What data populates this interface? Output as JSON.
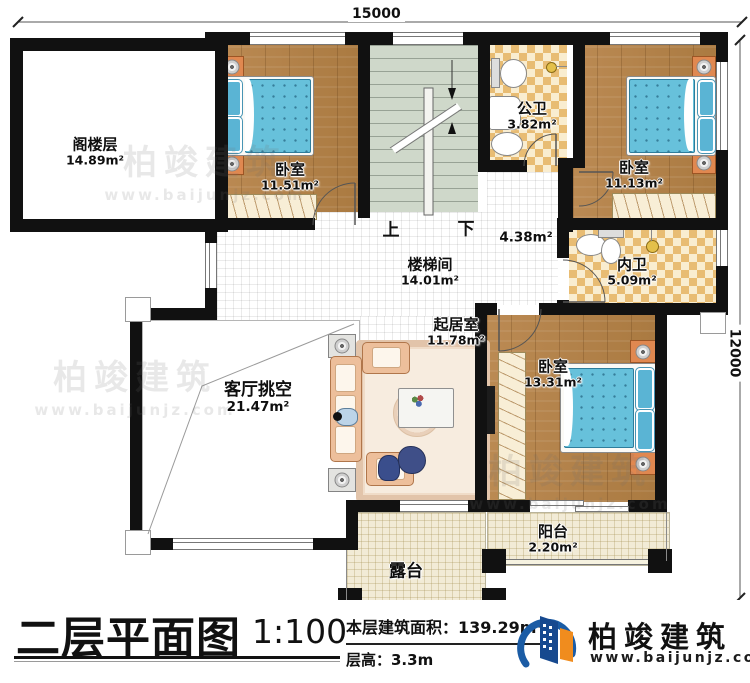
{
  "dimensions": {
    "width_top": "15000",
    "height_right": "12000"
  },
  "rooms": {
    "attic": {
      "name": "阁楼层",
      "area": "14.89m²"
    },
    "bedroom1": {
      "name": "卧室",
      "area": "11.51m²"
    },
    "public_bath": {
      "name": "公卫",
      "area": "3.82m²"
    },
    "bedroom2": {
      "name": "卧室",
      "area": "11.13m²"
    },
    "stairwell": {
      "name": "楼梯间",
      "area": "14.01m²"
    },
    "hall": {
      "area": "4.38m²"
    },
    "ensuite_bath": {
      "name": "内卫",
      "area": "5.09m²"
    },
    "sitting": {
      "name": "起居室",
      "area": "11.78m²"
    },
    "living_void": {
      "name": "客厅挑空",
      "area": "21.47m²"
    },
    "bedroom3": {
      "name": "卧室",
      "area": "13.31m²"
    },
    "balcony": {
      "name": "阳台",
      "area": "2.20m²"
    },
    "terrace": {
      "name": "露台"
    }
  },
  "stairs": {
    "up": "上",
    "down": "下"
  },
  "footer": {
    "title": "二层平面图",
    "scale": "1:100",
    "area_line": "本层建筑面积：139.29m²",
    "floor_height_line": "层高：3.3m"
  },
  "brand": {
    "name": "柏竣建筑",
    "url": "www.baijunjz.com"
  },
  "colors": {
    "wall": "#111111",
    "wood": "#b5834e",
    "checker_dark": "#e8bc73",
    "checker_light": "#f9edd0",
    "stair_floor": "#cfd8ca",
    "outdoor_tile": "#f2ebd6",
    "bed_blue": "#67c1db",
    "nightstand_orange": "#e08850",
    "sofa_peach": "#edbf9b",
    "brand_blue": "#1b5ca5",
    "brand_orange": "#f08c1e"
  }
}
